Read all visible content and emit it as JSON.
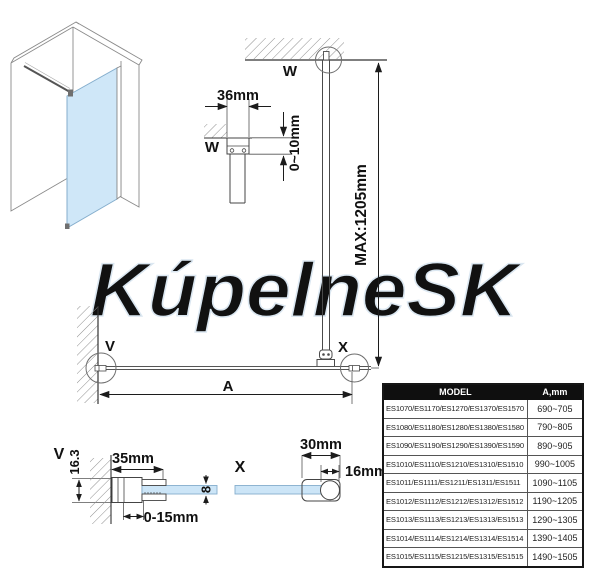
{
  "watermark": "KúpelneSK",
  "details": {
    "w": "W",
    "v": "V",
    "x": "X"
  },
  "dims": {
    "w_width": "36mm",
    "w_gap": "0~10mm",
    "max_height": "MAX:1205mm",
    "span": "A",
    "v_height": "16.3",
    "v_width": "35mm",
    "v_adjust": "0-15mm",
    "glass_thickness": "8",
    "x_width": "30mm",
    "x_bar_dia": "16mm"
  },
  "table": {
    "header": {
      "model": "MODEL",
      "a": "A,mm"
    },
    "rows": [
      {
        "model": "ES1070/ES1170/ES1270/ES1370/ES1570",
        "a": "690~705"
      },
      {
        "model": "ES1080/ES1180/ES1280/ES1380/ES1580",
        "a": "790~805"
      },
      {
        "model": "ES1090/ES1190/ES1290/ES1390/ES1590",
        "a": "890~905"
      },
      {
        "model": "ES1010/ES1110/ES1210/ES1310/ES1510",
        "a": "990~1005"
      },
      {
        "model": "ES1011/ES1111/ES1211/ES1311/ES1511",
        "a": "1090~1105"
      },
      {
        "model": "ES1012/ES1112/ES1212/ES1312/ES1512",
        "a": "1190~1205"
      },
      {
        "model": "ES1013/ES1113/ES1213/ES1313/ES1513",
        "a": "1290~1305"
      },
      {
        "model": "ES1014/ES1114/ES1214/ES1314/ES1514",
        "a": "1390~1405"
      },
      {
        "model": "ES1015/ES1115/ES1215/ES1315/ES1515",
        "a": "1490~1505"
      }
    ]
  },
  "colors": {
    "glass": "#cce5f7",
    "line": "#4a4a4a",
    "dimension": "#1c1c1c",
    "table_header_bg": "#0f0f0f",
    "watermark_outline": "#dbe7f1"
  }
}
